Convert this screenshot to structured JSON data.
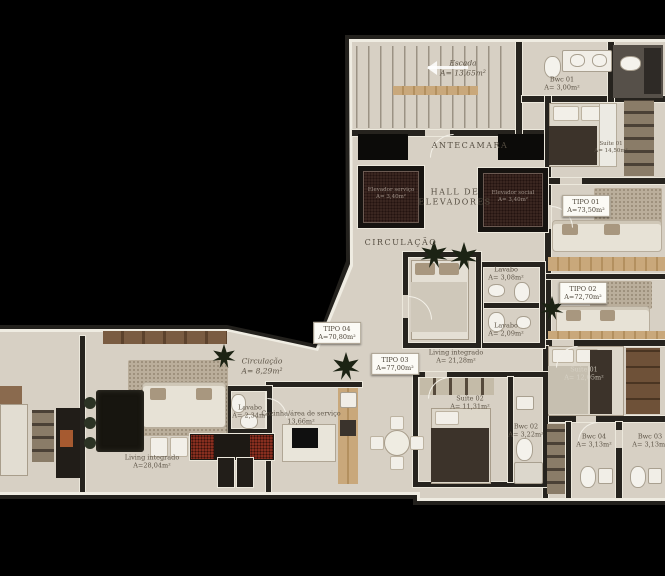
{
  "plan_title": "Pavement floor plan",
  "colors": {
    "background": "#000000",
    "floor": "#d7d0c4",
    "walls": "#23211d",
    "trim": "#efece2",
    "elevator_shaft": "#3a2620",
    "wood_accent": "#c9a87b",
    "wine_rack_red": "#872e1f",
    "label_text": "#5d5447"
  },
  "rooms": {
    "escada": {
      "name": "Escada",
      "area": "A= 13,65m²"
    },
    "antecamara": {
      "name": "ANTECAMARA",
      "area": ""
    },
    "hall_elevadores": {
      "line1": "HALL DE",
      "line2": "ELEVADORES"
    },
    "circulacao_hall": {
      "name": "CIRCULAÇÃO",
      "area": ""
    },
    "elevador_1": {
      "name": "Elevador serviço",
      "area": "A= 3,40m²"
    },
    "elevador_2": {
      "name": "Elevador social",
      "area": "A= 3,40m²"
    },
    "bwc01": {
      "name": "Bwc 01",
      "area": "A= 3,00m²"
    },
    "suite01_tipo01": {
      "name": "Suíte 01",
      "area": "A= 14,50m²"
    },
    "tipo01": {
      "name": "TIPO 01",
      "area": "A=73,50m²"
    },
    "tipo02": {
      "name": "TIPO 02",
      "area": "A=72,70m²"
    },
    "lavabo_tipo01": {
      "name": "Lavabo",
      "area": "A= 3,08m²"
    },
    "lavabo_tipo02": {
      "name": "Lavabo",
      "area": "A= 2,09m²"
    },
    "tipo04": {
      "name": "TIPO 04",
      "area": "A=70,80m²"
    },
    "tipo03": {
      "name": "TIPO 03",
      "area": "A=77,00m²"
    },
    "circulacao_comum": {
      "name": "Circulação",
      "area": "A= 8,29m²"
    },
    "living_tipo03": {
      "name": "Living integrado",
      "area": "A= 21,28m²"
    },
    "suite02_tipo03": {
      "name": "Suíte 02",
      "area": "A= 11,31m²"
    },
    "suite01_tipo02": {
      "name": "Suíte 01",
      "area": "A= 12,05m²"
    },
    "bwc02": {
      "name": "Bwc 02",
      "area": "A= 3,22m²"
    },
    "bwc04": {
      "name": "Bwc 04",
      "area": "A= 3,13m²"
    },
    "bwc03": {
      "name": "Bwc 03",
      "area": "A= 3,13m²"
    },
    "living_tipo04": {
      "name": "Living integrado",
      "area": "A=28,04m²"
    },
    "lavabo_tipo04": {
      "name": "Lavabo",
      "area": "A= 2,34m²"
    },
    "cozinha_tipo04": {
      "name": "Cozinha/área de serviço",
      "area": "13,66m²"
    }
  }
}
